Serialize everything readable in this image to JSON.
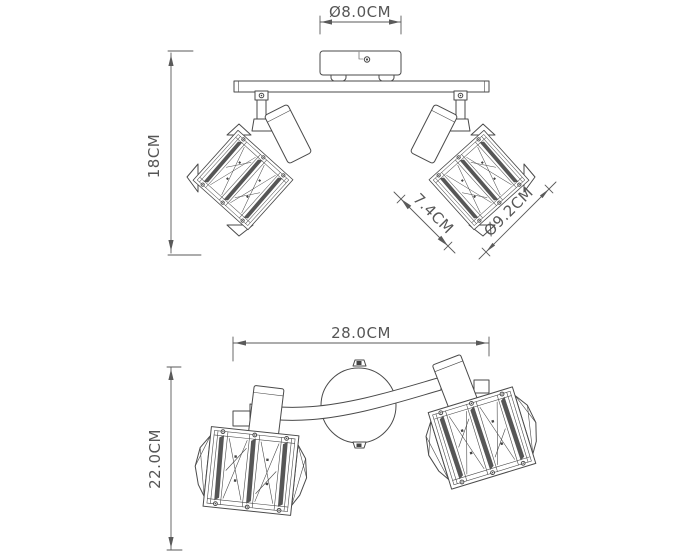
{
  "drawing": {
    "type": "product-dimension-diagram",
    "subject": "two-head ceiling spotlight with crystal cube shades",
    "colors": {
      "background": "#ffffff",
      "line": "#4a4a4a",
      "dimension": "#5a5a5a"
    },
    "top_view": {
      "canopy_diameter": "Ø8.0CM",
      "height": "18CM",
      "shade_width": "7.4CM",
      "shade_diagonal": "Ø9.2CM"
    },
    "bottom_view": {
      "width": "28.0CM",
      "depth": "22.0CM"
    }
  }
}
